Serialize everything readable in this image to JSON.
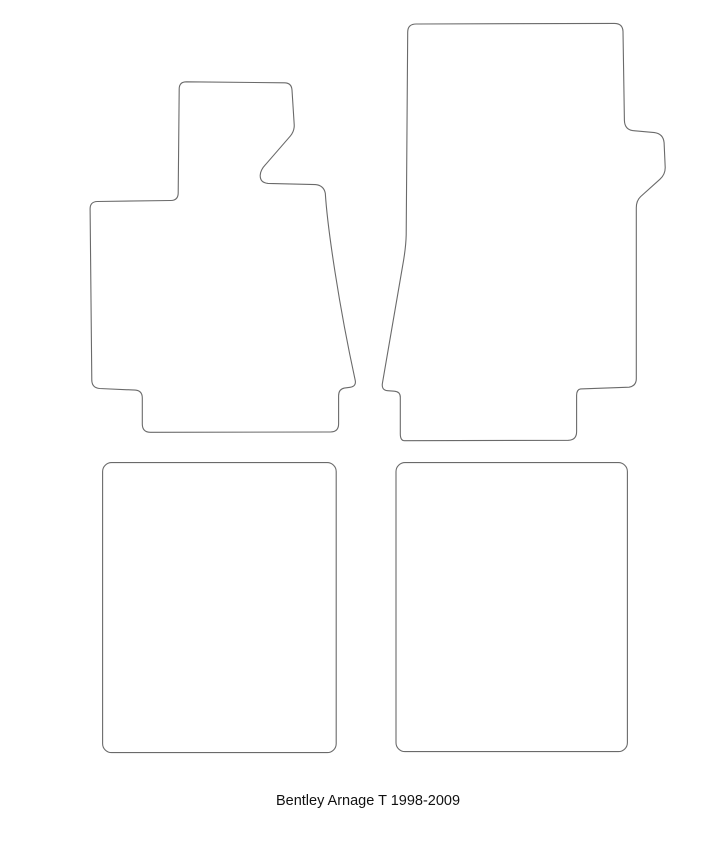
{
  "caption": {
    "text": "Bentley Arnage T 1998-2009"
  },
  "style": {
    "background": "#ffffff",
    "line_color": "#6a6a6a",
    "caption_color": "#111111"
  },
  "figure": {
    "type": "outline-diagram",
    "subject": "tailored car floor mat set templates",
    "items": [
      {
        "id": "front-left-mat",
        "label": "front left mat outline"
      },
      {
        "id": "front-right-mat",
        "label": "front right mat outline"
      },
      {
        "id": "rear-left-mat",
        "label": "rear left mat outline"
      },
      {
        "id": "rear-right-mat",
        "label": "rear right mat outline"
      }
    ]
  }
}
